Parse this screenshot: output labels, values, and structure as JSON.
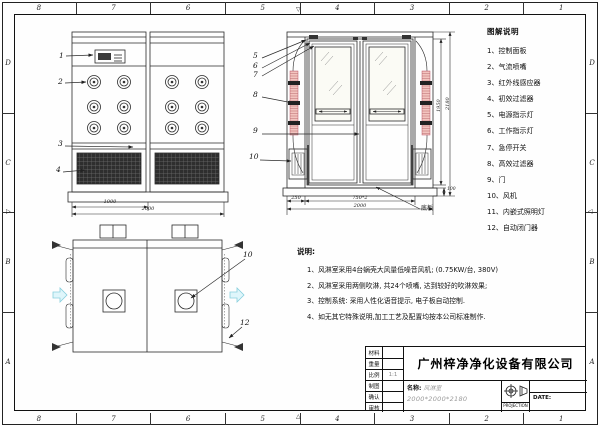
{
  "frame": {
    "top_zones": [
      "8",
      "7",
      "6",
      "5",
      "4",
      "3",
      "2",
      "1"
    ],
    "bottom_zones": [
      "8",
      "7",
      "6",
      "5",
      "4",
      "3",
      "2",
      "1"
    ],
    "left_zones": [
      "D",
      "C",
      "B",
      "A"
    ],
    "right_zones": [
      "D",
      "C",
      "B",
      "A"
    ]
  },
  "legend": {
    "title": "图解说明",
    "items": [
      "1、控制面板",
      "2、气流喷嘴",
      "3、红外线感应器",
      "4、初效过滤器",
      "5、电源指示灯",
      "6、工作指示灯",
      "7、急停开关",
      "8、高效过滤器",
      "9、门",
      "10、风机",
      "11、内嵌式照明灯",
      "12、自动闭门器"
    ]
  },
  "notes": {
    "title": "说明:",
    "lines": [
      "1、风淋室采用4台蜗壳大风量低噪音风机; (0.75KW/台, 380V)",
      "2、风淋室采用两侧吹淋, 共24个喷嘴, 达到较好的吹淋效果;",
      "3、控制系统: 采用人性化语音提示, 电子板自动控制.",
      "4、如无其它特殊说明,加工工艺及配置均按本公司标准制作."
    ]
  },
  "views": {
    "side": {
      "callouts": [
        "1",
        "2",
        "3",
        "4"
      ],
      "dim_width_half": "1000",
      "dim_width_total": "2000"
    },
    "front": {
      "callouts": [
        "5",
        "6",
        "7",
        "8",
        "9",
        "10"
      ],
      "dim_left": "250",
      "dim_doors": "750*2",
      "dim_total": "2000",
      "dim_door_height": "1950",
      "dim_total_height": "2180",
      "dim_base": "100",
      "leader_label": "底板"
    },
    "plan": {
      "callout_fan": "10",
      "callout_closer": "12"
    }
  },
  "title_block": {
    "company": "广州梓净净化设备有限公司",
    "rows": [
      {
        "label": "材料",
        "value": ""
      },
      {
        "label": "重量",
        "value": ""
      },
      {
        "label": "比例",
        "value": "1:1"
      },
      {
        "label": "制图",
        "value": ""
      },
      {
        "label": "确认",
        "value": ""
      },
      {
        "label": "审核",
        "value": ""
      }
    ],
    "name_label": "名称:",
    "product_name": "风淋室",
    "product_size": "2000*2000*2180",
    "projection_label": "PROJECTION",
    "date_label": "DATE:"
  },
  "colors": {
    "line": "#2a2a2a",
    "pink_filter": "#f3c4bf",
    "cyan_arrow": "#dff6fb",
    "gray_text": "#9a9a9a"
  }
}
